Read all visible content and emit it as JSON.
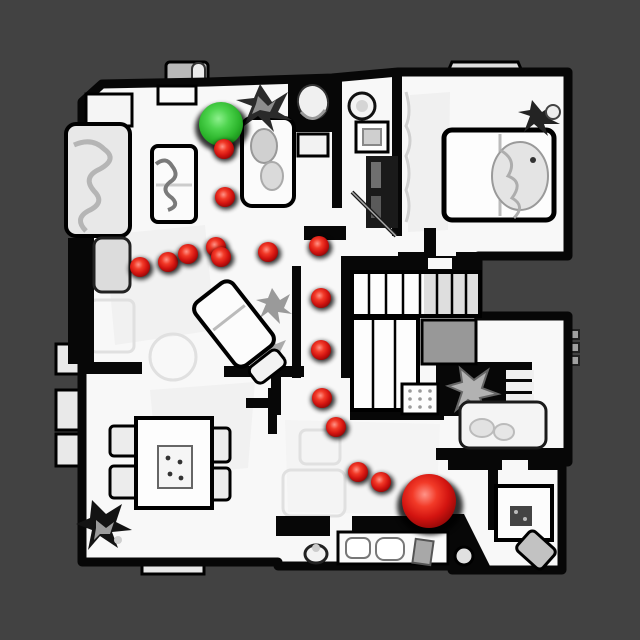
{
  "view": {
    "background_color": "#424242",
    "floor_color": "#f8f8f8",
    "wall_color": "#070707",
    "canvas": {
      "width": 640,
      "height": 640
    }
  },
  "markers": {
    "start": {
      "label": "start-sphere",
      "shape": "sphere",
      "color": "#2fbf2f",
      "x": 221,
      "y": 124,
      "radius": 22
    },
    "goal": {
      "label": "goal-sphere",
      "shape": "sphere",
      "color": "#d81111",
      "x": 429,
      "y": 501,
      "radius": 27
    },
    "waypoint_color": "#d81111",
    "waypoint_radius": 10,
    "waypoints": [
      [
        224,
        149
      ],
      [
        225,
        197
      ],
      [
        140,
        267
      ],
      [
        168,
        262
      ],
      [
        188,
        254
      ],
      [
        216,
        247
      ],
      [
        221,
        257
      ],
      [
        268,
        252
      ],
      [
        319,
        246
      ],
      [
        321,
        298
      ],
      [
        321,
        350
      ],
      [
        322,
        398
      ],
      [
        336,
        427
      ],
      [
        358,
        472
      ],
      [
        381,
        482
      ]
    ]
  }
}
